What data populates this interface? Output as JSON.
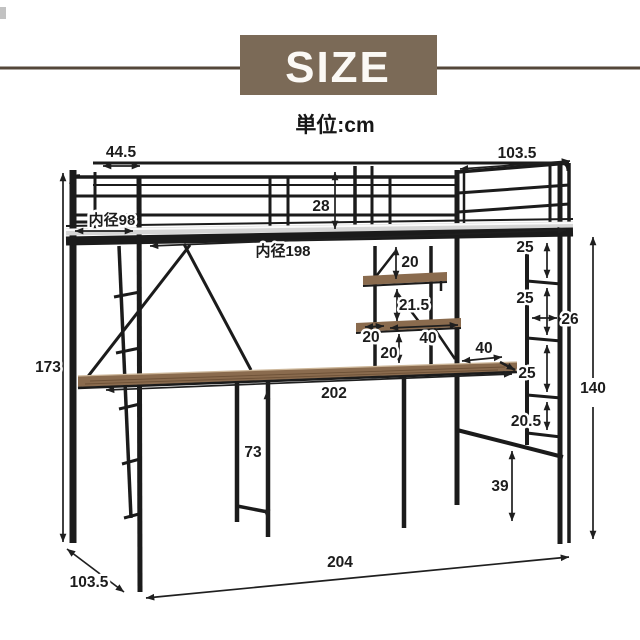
{
  "header": {
    "title": "SIZE",
    "unit_note": "単位:cm"
  },
  "colors": {
    "banner": "#7b6a57",
    "rule_line": "#54473a",
    "frame": "#1b1b1b",
    "wood": "#8a6b4e",
    "wood_grain": "#6d5137",
    "wood_highlight": "#cdb79a",
    "platform_gray": "#d5d5d5",
    "text": "#1c1c1c"
  },
  "dimensions": {
    "head_section_width": "44.5",
    "bed_end_depth": "103.5",
    "guardrail_height": "28",
    "inner_depth": "内径98",
    "inner_length": "内径198",
    "total_height": "173",
    "bed_to_upper_shelf": "20",
    "upper_to_lower_shelf": "21.5",
    "lower_shelf_offset": "20",
    "lower_shelf_width": "40",
    "lower_shelf_to_desk": "20",
    "desk_length": "202",
    "desk_to_ladder": "40",
    "ladder_gap_1": "25",
    "ladder_gap_2": "25",
    "ladder_width": "26",
    "ladder_gap_3": "25",
    "ladder_gap_4": "20.5",
    "underbed_height": "140",
    "rail_to_floor": "39",
    "desk_height": "73",
    "total_length": "204",
    "total_depth": "103.5"
  }
}
